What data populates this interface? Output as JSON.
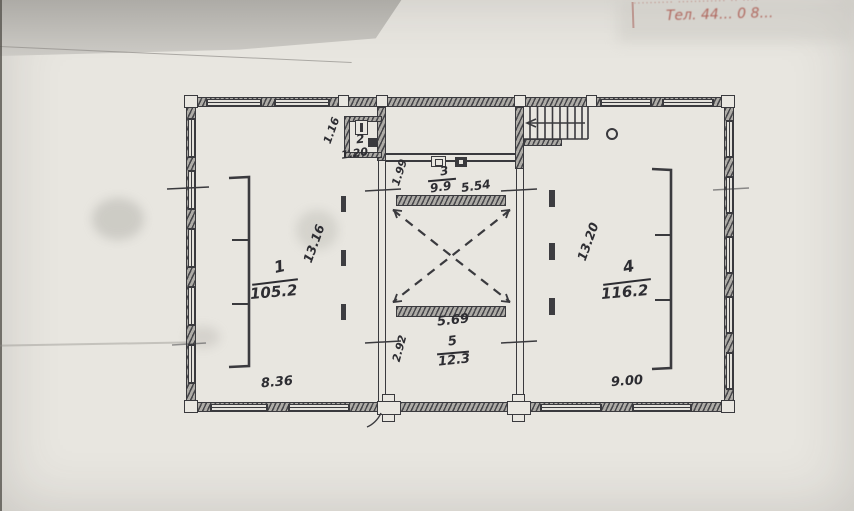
{
  "photo": {
    "paper_color": "#e8e6e0",
    "ink_color": "#3a3a3e",
    "stamp_color": "#a5493f"
  },
  "stamp": {
    "line1": "·········· ············ ·· ····",
    "line2": "Тел. 44…  0 8…"
  },
  "rooms": {
    "r1": {
      "number": "1",
      "area": "105.2"
    },
    "r2": {
      "number": "2"
    },
    "r3": {
      "number": "3",
      "area": "9.9"
    },
    "r4": {
      "number": "4",
      "area": "116.2"
    },
    "r5": {
      "number": "5",
      "area": "12.3"
    }
  },
  "dims": {
    "v116": "1.16",
    "h120": "1.20",
    "v199": "1.99",
    "h554": "5.54",
    "v1316": "13.16",
    "v1320": "13.20",
    "h569": "5.69",
    "v292": "2.92",
    "h836": "8.36",
    "h900": "9.00"
  }
}
